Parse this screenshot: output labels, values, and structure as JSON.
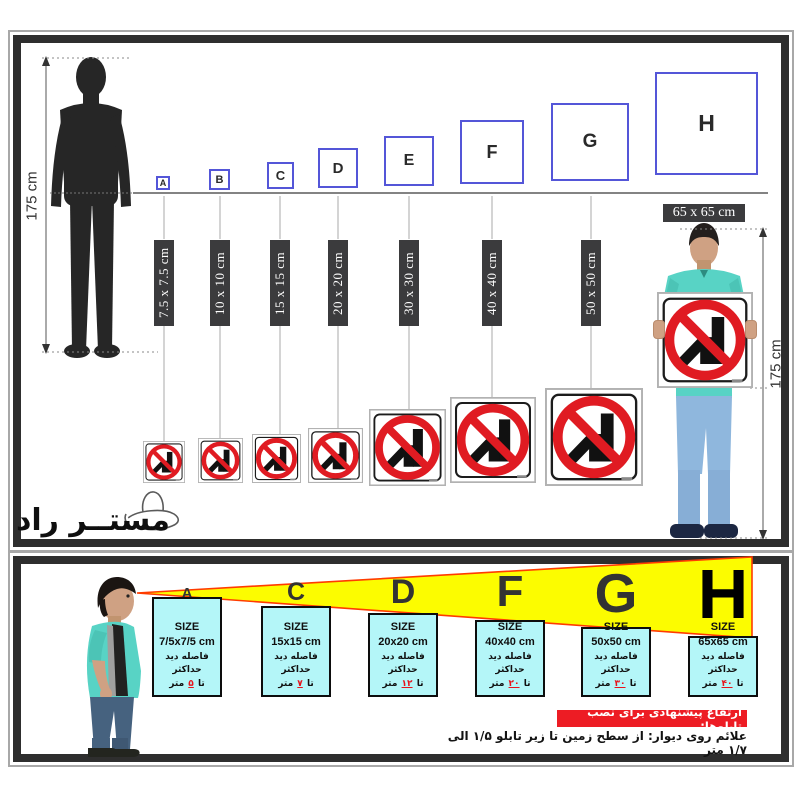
{
  "brand": {
    "logo_text": "مستــر راد",
    "hat_icon": "cowboy-hat-icon"
  },
  "top_panel": {
    "person_height_label": "175 cm",
    "model_height_label": "175 cm",
    "held_sign_label": "65 x 65 cm",
    "squares": [
      {
        "letter": "A",
        "bar_label": "7.5 x 7.5 cm"
      },
      {
        "letter": "B",
        "bar_label": "10 x 10 cm"
      },
      {
        "letter": "C",
        "bar_label": "15 x 15 cm"
      },
      {
        "letter": "D",
        "bar_label": "20 x 20 cm"
      },
      {
        "letter": "E",
        "bar_label": "30 x 30 cm"
      },
      {
        "letter": "F",
        "bar_label": "40 x 40 cm"
      },
      {
        "letter": "G",
        "bar_label": "50 x 50 cm"
      },
      {
        "letter": "H",
        "bar_label": "65 x 65 cm"
      }
    ],
    "sign_icon": "no-hammering-prohibition-icon"
  },
  "bottom_panel": {
    "panels": [
      {
        "letter": "A",
        "size_title": "SIZE",
        "size_value": "7/5x7/5 cm",
        "distance_label": "فاصله دید حداکثر",
        "prefix": "تا",
        "value": "۵",
        "suffix": "متر"
      },
      {
        "letter": "C",
        "size_title": "SIZE",
        "size_value": "15x15 cm",
        "distance_label": "فاصله دید حداکثر",
        "prefix": "تا",
        "value": "۷",
        "suffix": "متر"
      },
      {
        "letter": "D",
        "size_title": "SIZE",
        "size_value": "20x20 cm",
        "distance_label": "فاصله دید حداکثر",
        "prefix": "تا",
        "value": "۱۲",
        "suffix": "متر"
      },
      {
        "letter": "F",
        "size_title": "SIZE",
        "size_value": "40x40 cm",
        "distance_label": "فاصله دید حداکثر",
        "prefix": "تا",
        "value": "۲۰",
        "suffix": "متر"
      },
      {
        "letter": "G",
        "size_title": "SIZE",
        "size_value": "50x50 cm",
        "distance_label": "فاصله دید حداکثر",
        "prefix": "تا",
        "value": "۳۰",
        "suffix": "متر"
      },
      {
        "letter": "H",
        "size_title": "SIZE",
        "size_value": "65x65 cm",
        "distance_label": "فاصله دید حداکثر",
        "prefix": "تا",
        "value": "۴۰",
        "suffix": "متر"
      }
    ],
    "heading": "ارتفاع پیشنهادی برای نصب تابلوها:",
    "note": "علائم روی دیوار: از سطح زمین تا زیر تابلو ۱/۵ الی ۱/۷ متر"
  },
  "colors": {
    "square_border": "#5456d8",
    "bar_background": "#3b3b3d",
    "prohibition_red": "#e01b22",
    "cone_yellow": "#fcfc00",
    "cone_edge": "#ff3c00",
    "panel_cyan": "#b4f6f8",
    "heading_red": "#ed1c24",
    "shirt_teal": "#58d3c5"
  }
}
